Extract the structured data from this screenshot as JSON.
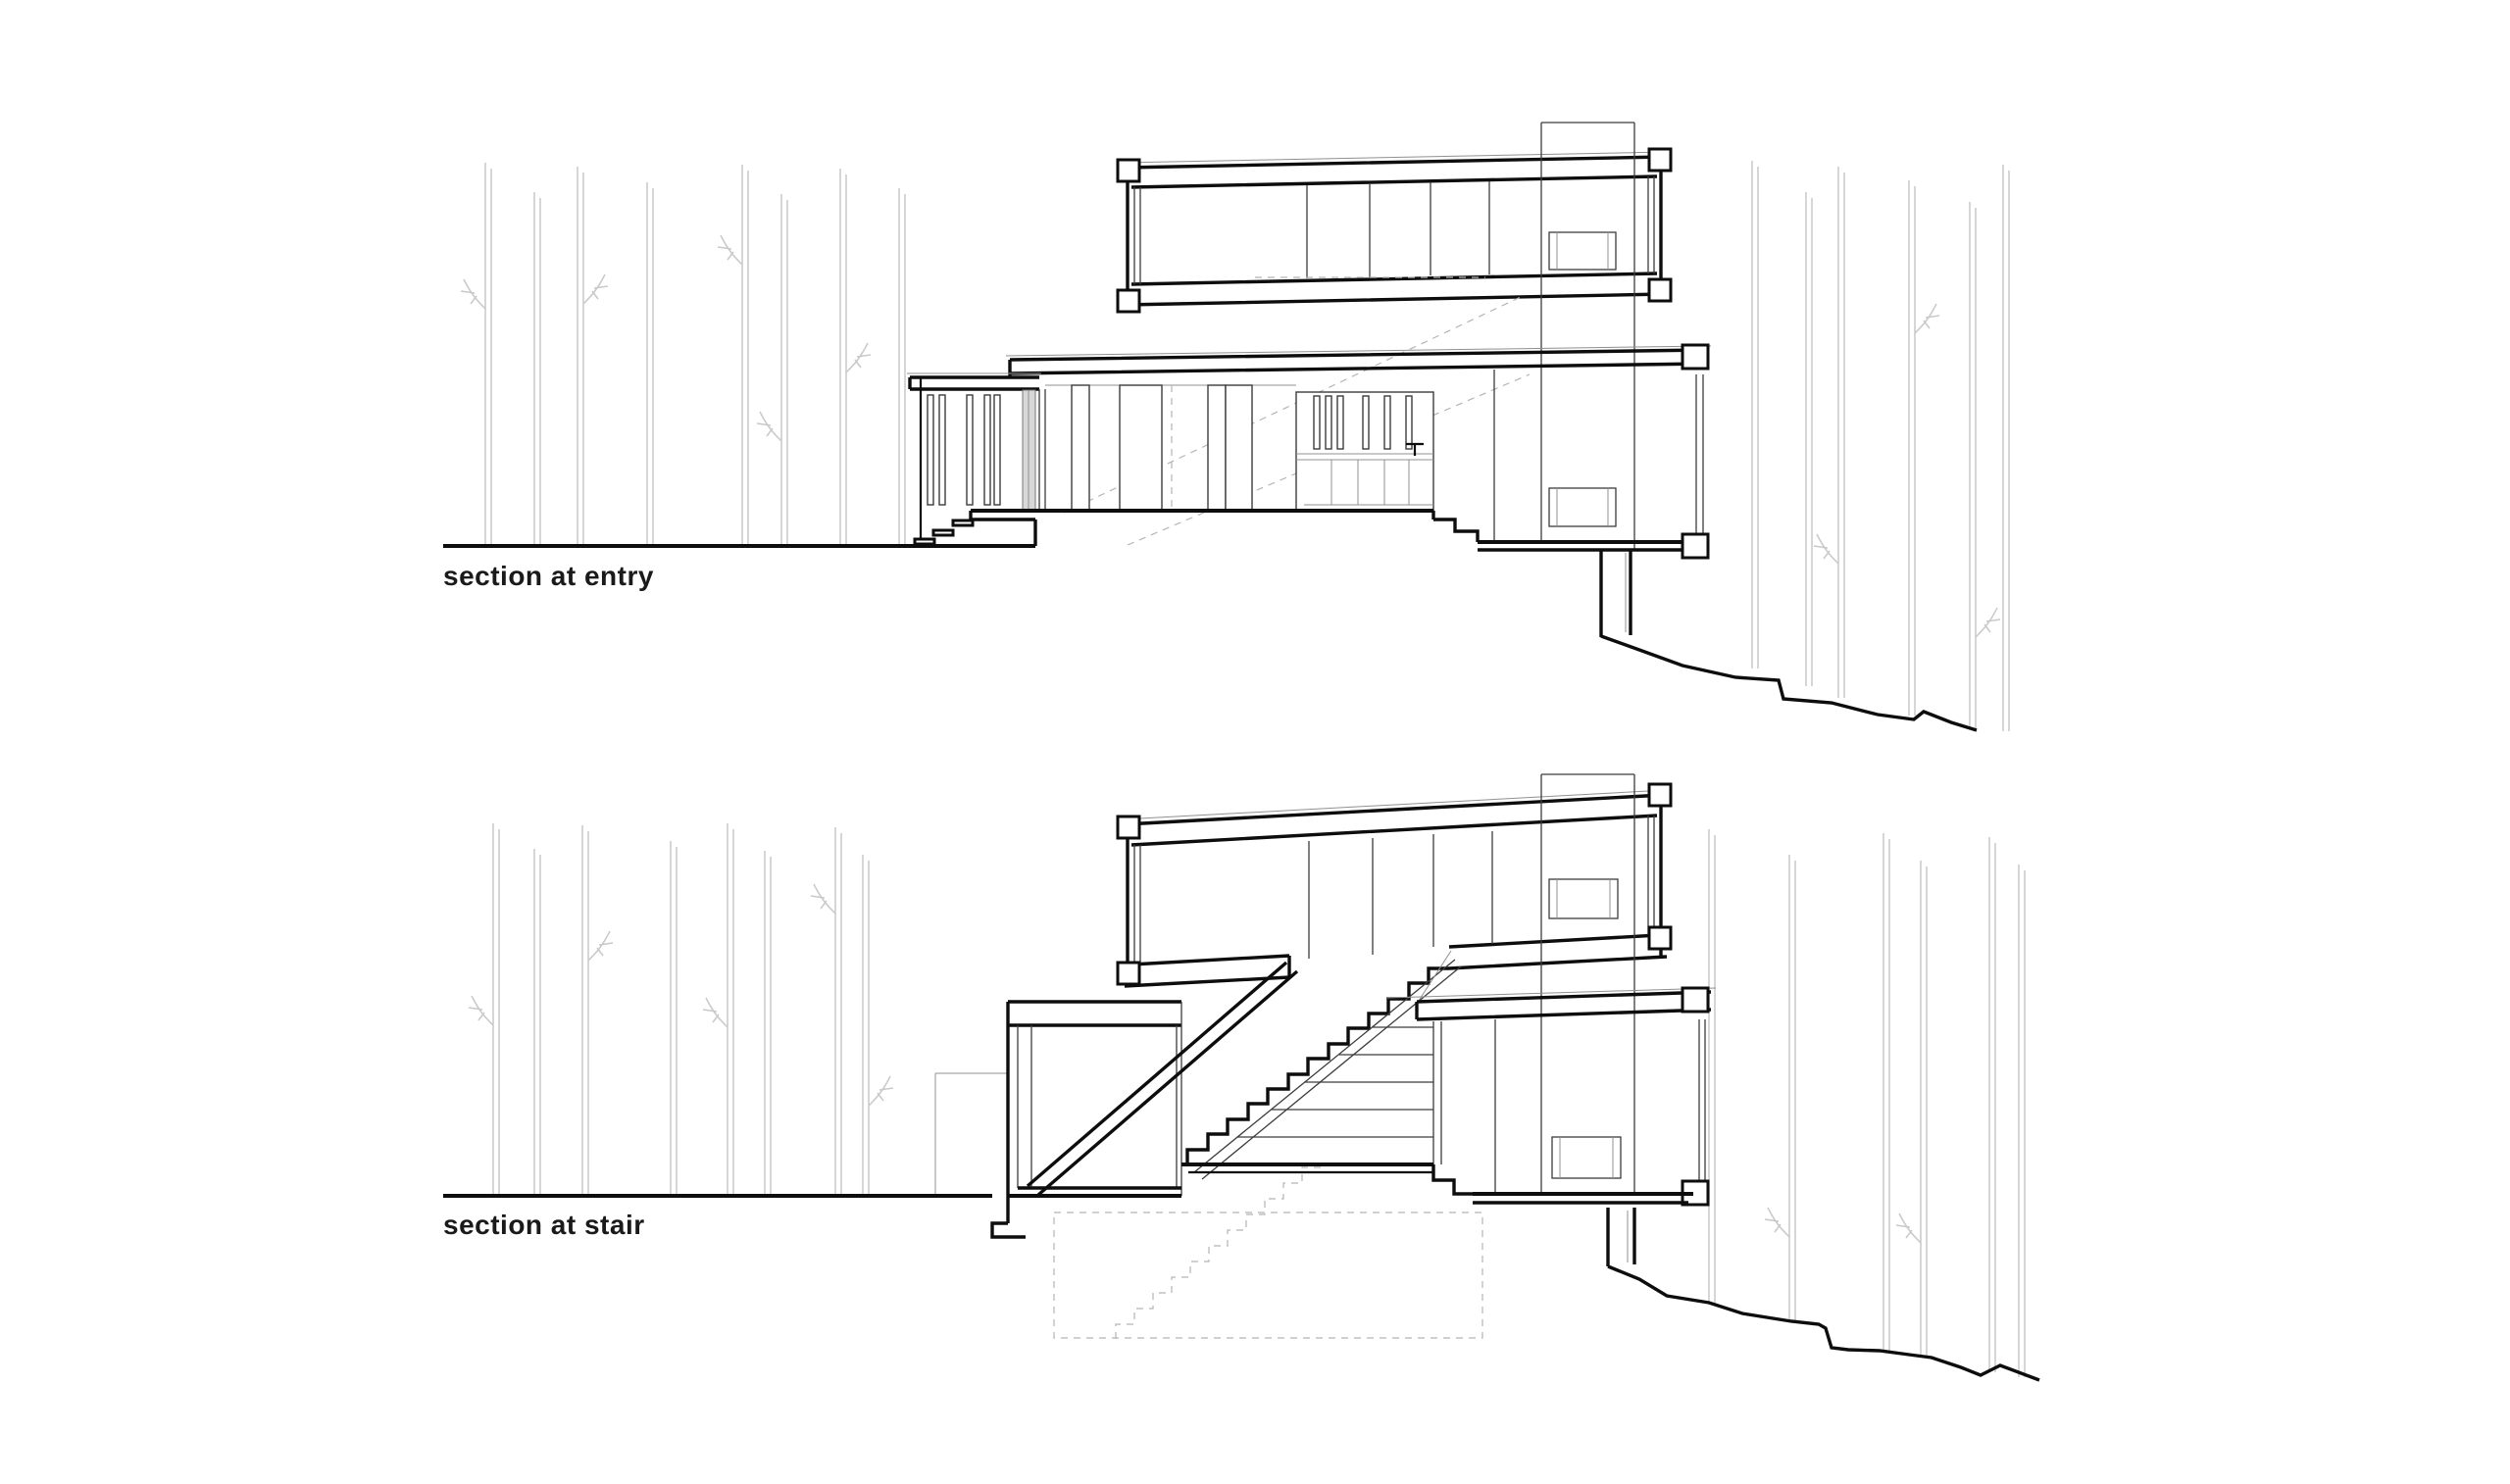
{
  "document": {
    "type": "architectural-section-drawing",
    "background": "#ffffff"
  },
  "drawings": [
    {
      "id": "entry",
      "label": "section at entry"
    },
    {
      "id": "stair",
      "label": "section at stair"
    }
  ],
  "colors": {
    "background": "#ffffff",
    "cut_line": "#0d0d0d",
    "thin_line": "#3c3c3c",
    "light_line": "#909090",
    "tree_line": "#c9c9c9",
    "dashed_line": "#b5b5b5",
    "glass_door_fill": "#d8d8d8",
    "label_text": "#1a1a1a"
  }
}
